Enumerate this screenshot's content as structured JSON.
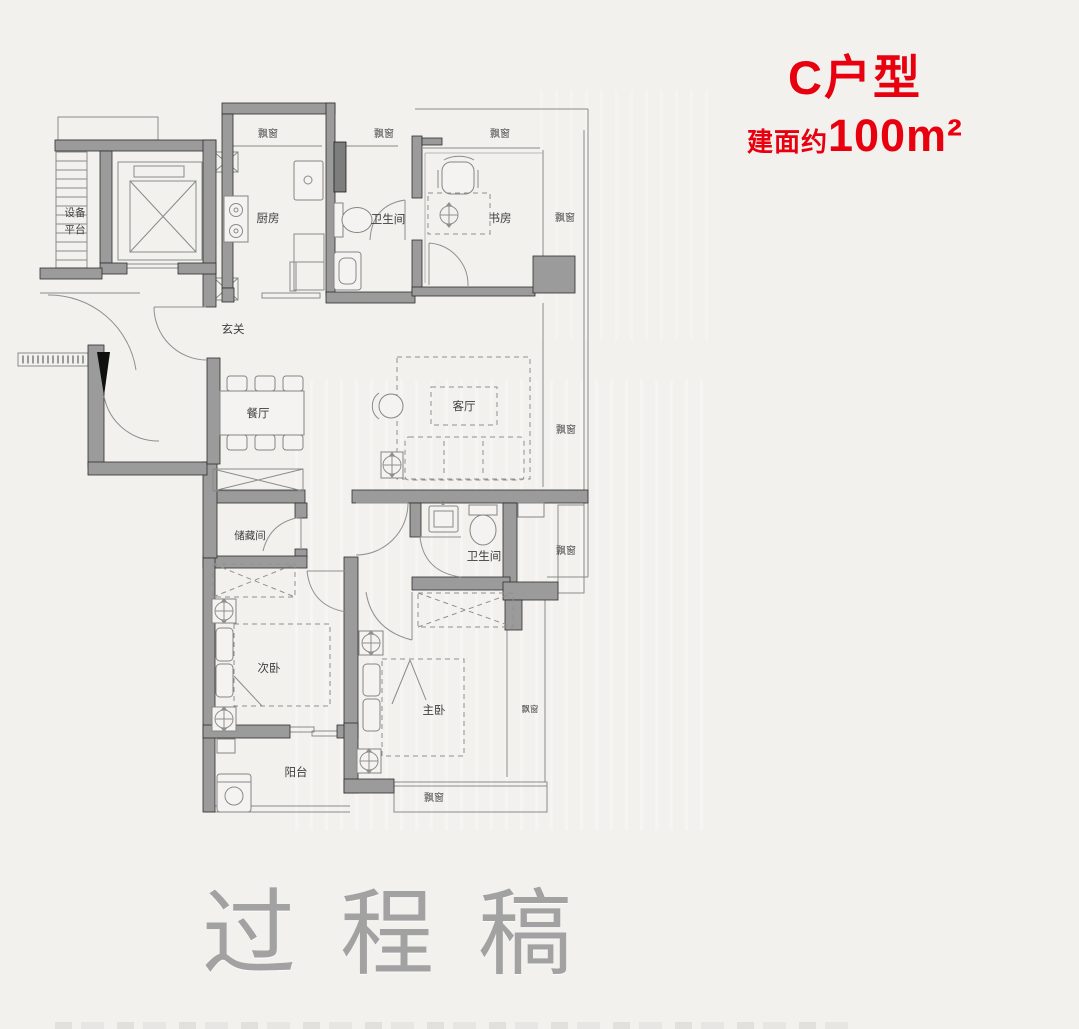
{
  "header": {
    "title": "C户型",
    "area_label": "建面约",
    "area_value": "100m²"
  },
  "rooms": {
    "equipment_platform": [
      "设备",
      "平台"
    ],
    "kitchen": "厨房",
    "bathroom_top": "卫生间",
    "study": "书房",
    "entry": "玄关",
    "dining": "餐厅",
    "living": "客厅",
    "storage": "储藏间",
    "bathroom_bottom": "卫生间",
    "secondary_bedroom": "次卧",
    "master_bedroom": "主卧",
    "balcony": "阳台"
  },
  "labels": {
    "bay_window": "飘窗"
  },
  "watermark": "过程稿",
  "colors": {
    "accent": "#e8000f",
    "wall": "#9b9b9b",
    "background": "#f2f1ee",
    "line": "#8a8a8a",
    "text": "#3d3d3d",
    "watermark": "#a2a2a2"
  }
}
